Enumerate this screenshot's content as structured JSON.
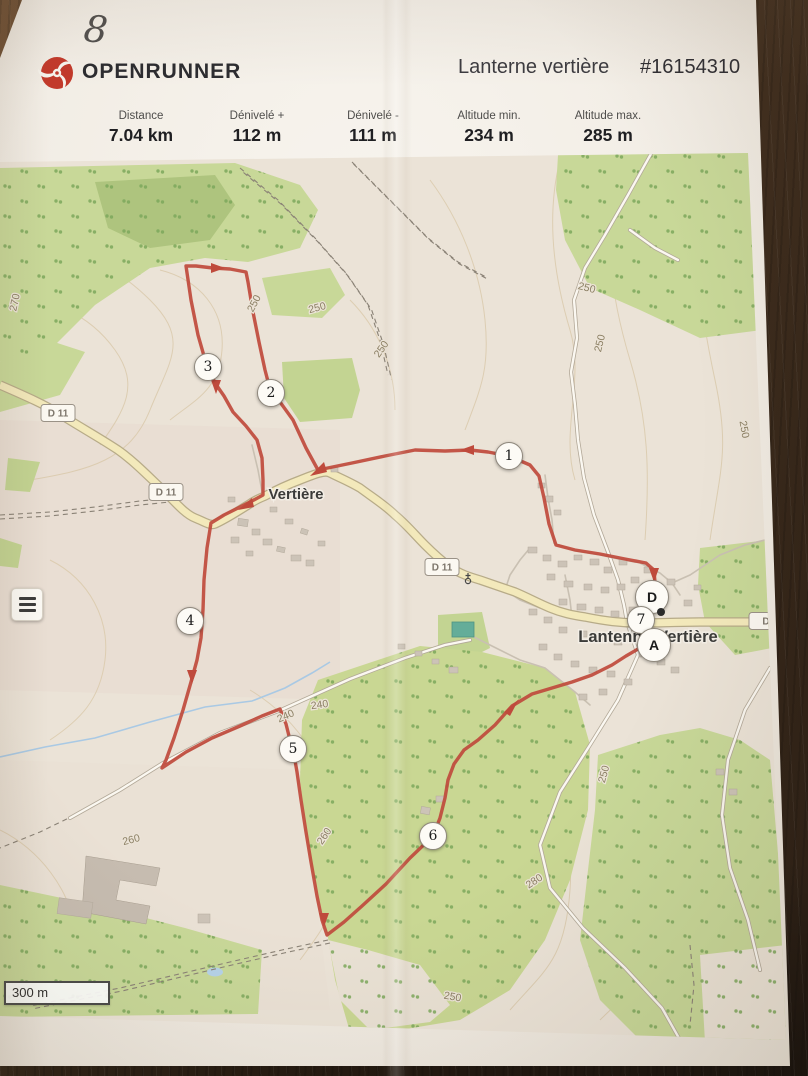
{
  "note": {
    "handwritten": "8"
  },
  "header": {
    "brand": "OPENRUNNER",
    "title": "Lanterne vertière",
    "route_id": "#16154310"
  },
  "stats": [
    {
      "label": "Distance",
      "value": "7.04 km"
    },
    {
      "label": "Dénivelé +",
      "value": "112 m"
    },
    {
      "label": "Dénivelé -",
      "value": "111 m"
    },
    {
      "label": "Altitude min.",
      "value": "234 m"
    },
    {
      "label": "Altitude max.",
      "value": "285 m"
    }
  ],
  "map": {
    "scale_label": "300 m",
    "route_color": "#bf4a3c",
    "place_labels": [
      {
        "text": "Vertière",
        "x": 296,
        "y": 499,
        "size": 15
      },
      {
        "text": "Lantenne-Vertière",
        "x": 648,
        "y": 642,
        "size": 16.5
      }
    ],
    "road_shields": [
      {
        "text": "D 11",
        "x": 58,
        "y": 413
      },
      {
        "text": "D 11",
        "x": 166,
        "y": 492
      },
      {
        "text": "D 11",
        "x": 442,
        "y": 567
      },
      {
        "text": "D",
        "x": 766,
        "y": 621
      }
    ],
    "contour_labels": [
      {
        "text": "270",
        "x": 18,
        "y": 303,
        "rot": -78
      },
      {
        "text": "250",
        "x": 257,
        "y": 305,
        "rot": -62
      },
      {
        "text": "250",
        "x": 318,
        "y": 311,
        "rot": -15
      },
      {
        "text": "250",
        "x": 384,
        "y": 351,
        "rot": -55
      },
      {
        "text": "250",
        "x": 586,
        "y": 291,
        "rot": 14
      },
      {
        "text": "250",
        "x": 603,
        "y": 344,
        "rot": -76
      },
      {
        "text": "250",
        "x": 741,
        "y": 430,
        "rot": 80
      },
      {
        "text": "240",
        "x": 320,
        "y": 708,
        "rot": -8
      },
      {
        "text": "240",
        "x": 287,
        "y": 719,
        "rot": -24
      },
      {
        "text": "260",
        "x": 327,
        "y": 838,
        "rot": -56
      },
      {
        "text": "260",
        "x": 132,
        "y": 843,
        "rot": -14
      },
      {
        "text": "280",
        "x": 536,
        "y": 884,
        "rot": -33
      },
      {
        "text": "250",
        "x": 607,
        "y": 775,
        "rot": -74
      },
      {
        "text": "250",
        "x": 452,
        "y": 1000,
        "rot": 10
      }
    ],
    "waypoints": [
      {
        "label": "1",
        "x": 509,
        "y": 456,
        "type": "km"
      },
      {
        "label": "2",
        "x": 271,
        "y": 393,
        "type": "km"
      },
      {
        "label": "3",
        "x": 208,
        "y": 367,
        "type": "km"
      },
      {
        "label": "4",
        "x": 190,
        "y": 621,
        "type": "km"
      },
      {
        "label": "5",
        "x": 293,
        "y": 749,
        "type": "km"
      },
      {
        "label": "6",
        "x": 433,
        "y": 836,
        "type": "km"
      },
      {
        "label": "D",
        "x": 652,
        "y": 597,
        "type": "endpoint"
      },
      {
        "label": "7",
        "x": 641,
        "y": 620,
        "type": "km"
      },
      {
        "label": "A",
        "x": 654,
        "y": 645,
        "type": "endpoint"
      }
    ],
    "start_dot": {
      "x": 661,
      "y": 612
    }
  }
}
